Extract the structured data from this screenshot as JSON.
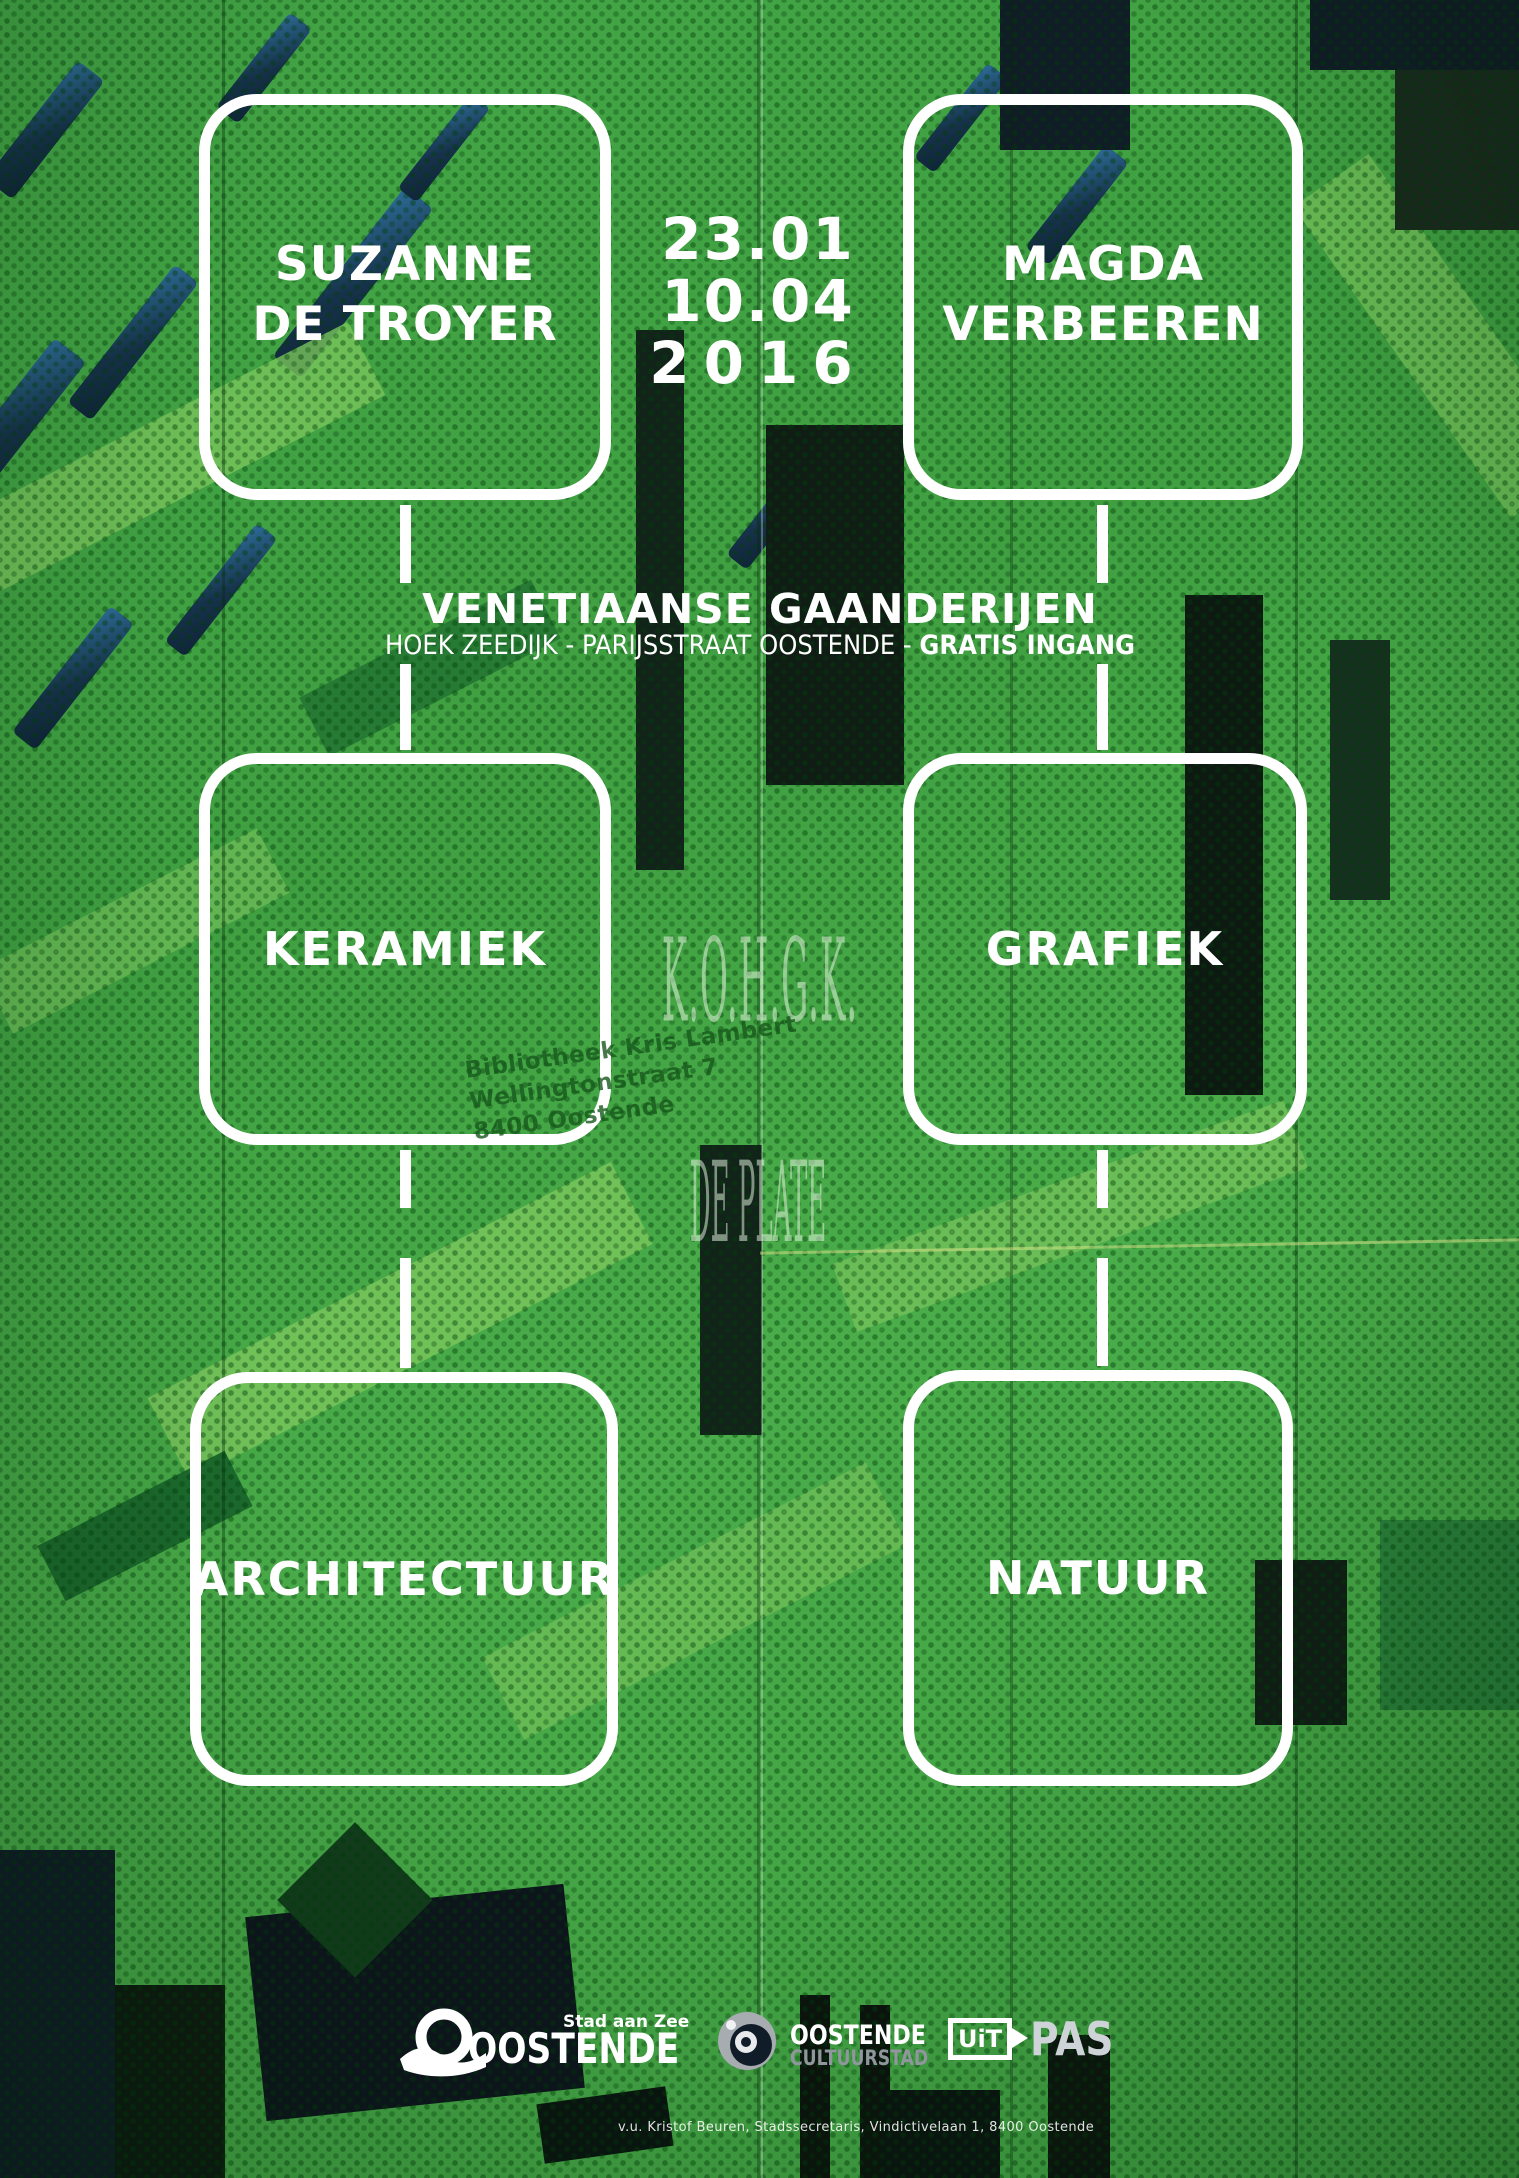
{
  "poster": {
    "artist_left": {
      "line1": "SUZANNE",
      "line2": "DE TROYER"
    },
    "artist_right": {
      "line1": "MAGDA",
      "line2": "VERBEEREN"
    },
    "dates": {
      "line1": "23.01",
      "line2": "10.04",
      "line3": "2016"
    },
    "venue": {
      "title": "VENETIAANSE GAANDERIJEN",
      "subtitle_regular": "HOEK ZEEDIJK - PARIJSSTRAAT OOSTENDE - ",
      "subtitle_bold": "GRATIS INGANG"
    },
    "categories": [
      {
        "id": "keramiek",
        "label": "KERAMIEK"
      },
      {
        "id": "grafiek",
        "label": "GRAFIEK"
      },
      {
        "id": "architectuur",
        "label": "ARCHITECTUUR"
      },
      {
        "id": "natuur",
        "label": "NATUUR"
      }
    ]
  },
  "overlays": {
    "kohgk_watermark": "K.O.H.G.K.",
    "de_plate_watermark": "DE PLATE",
    "library_stamp": {
      "line1": "Bibliotheek Kris Lambert",
      "line2": "Wellingtonstraat 7",
      "line3": "8400 Oostende"
    }
  },
  "footer": {
    "oostende_logo": {
      "tagline": "Stad aan Zee",
      "name": "OOSTENDE"
    },
    "cultuurstad_logo": {
      "line1": "OOSTENDE",
      "line2": "CULTUURSTAD"
    },
    "uitpas_logo": {
      "uit": "UiT",
      "pas": "PAS"
    },
    "credit": "v.u. Kristof Beuren, Stadssecretaris, Vindictivelaan 1, 8400 Oostende"
  },
  "colors": {
    "facade_green": "#42a444",
    "facade_green_light": "#79c55d",
    "facade_green_dark": "#1c6a2d",
    "facade_navy": "#16324a",
    "panel_hole_green": "#0a3e08",
    "frame_white": "#ffffff",
    "stamp_green": "#17581c",
    "cultuurstad_grey": "#8f969c"
  }
}
